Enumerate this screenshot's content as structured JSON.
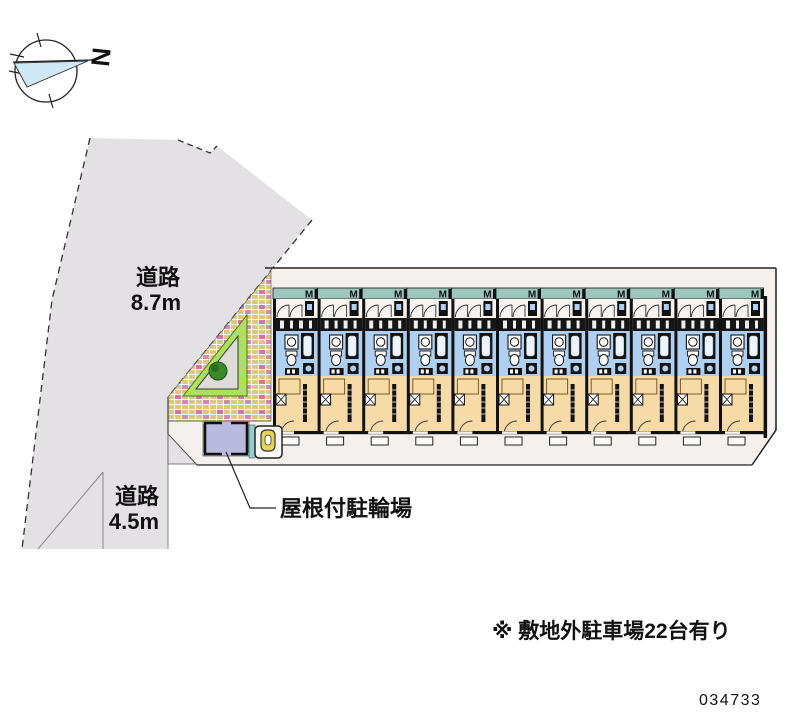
{
  "compass": {
    "north_label": "N"
  },
  "roads": {
    "northwest": {
      "name": "道路",
      "width": "8.7m"
    },
    "south": {
      "name": "道路",
      "width": "4.5m"
    }
  },
  "labels": {
    "bicycle_parking": "屋根付駐輪場",
    "offsite_parking_note": "※ 敷地外駐車場22台有り",
    "plan_number": "034733"
  },
  "building": {
    "unit_count": 11,
    "balcony_mark": "M"
  },
  "colors": {
    "road": "#e4e1e4",
    "site_ground": "#f3f0ee",
    "brick_base": "#d9c87e",
    "brick_accent": "#e06ea6",
    "lawn": "#ace05e",
    "planter": "#dedcda",
    "tree": "#3a8a28",
    "balcony_strip": "#9fc6bd",
    "bathroom_blue": "#aed0f2",
    "living_tan": "#f7dba6",
    "bike_shed": "#babade",
    "vending_yellow": "#e8d352",
    "compass_fill": "#cfe8f5"
  }
}
